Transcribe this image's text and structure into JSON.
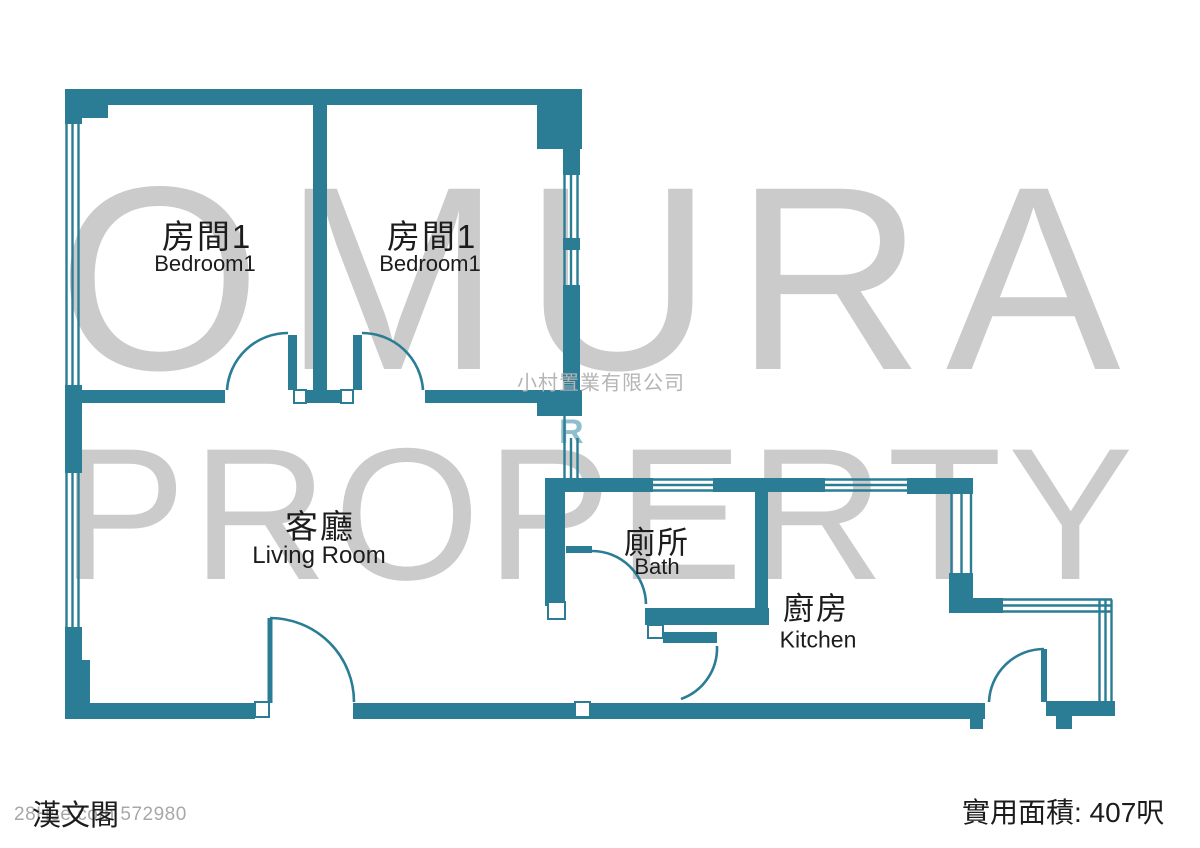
{
  "colors": {
    "wall": "#2a7d95",
    "watermark": "#cbcbcb",
    "watermark_small": "#b5b5b5",
    "ink": "#1c1c1c",
    "fragment_teal": "#8fbfcc"
  },
  "watermarks": {
    "brand_line1": "OMURA",
    "brand_line2": "PROPERTY",
    "agency": "小村置業有限公司",
    "listing_id": "28Hse.com 572980",
    "fragment_letter": "R"
  },
  "floor_plan": {
    "rooms": [
      {
        "name_zh": "房間1",
        "name_en": "Bedroom1"
      },
      {
        "name_zh": "房間1",
        "name_en": "Bedroom1"
      },
      {
        "name_zh": "客廳",
        "name_en": "Living Room"
      },
      {
        "name_zh": "廁所",
        "name_en": "Bath"
      },
      {
        "name_zh": "廚房",
        "name_en": "Kitchen"
      }
    ]
  },
  "footer": {
    "building_name": "漢文閣",
    "usable_area": "實用面積: 407呎"
  }
}
